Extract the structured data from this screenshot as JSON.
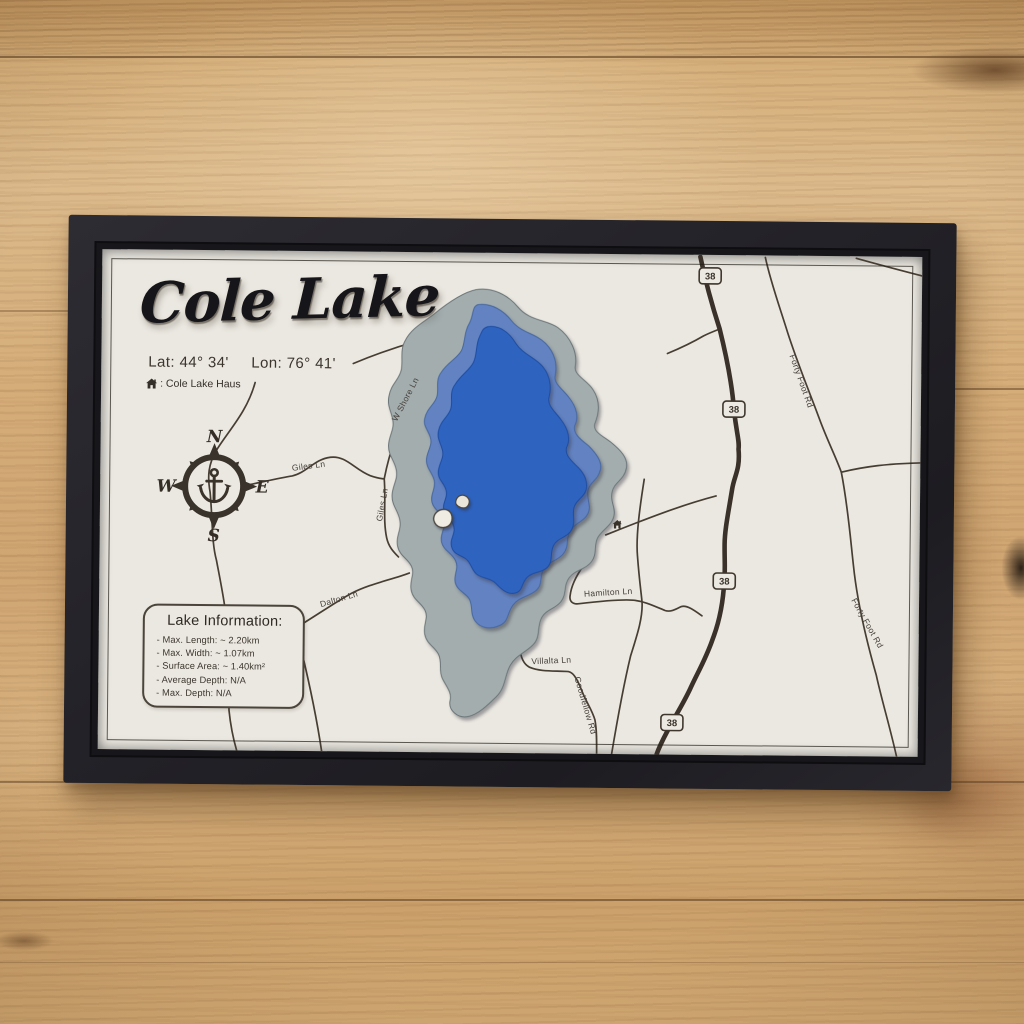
{
  "artwork": {
    "title": "Cole Lake",
    "lat_label": "Lat: 44° 34'",
    "lon_label": "Lon: 76° 41'",
    "legend_house_label": ": Cole Lake Haus",
    "compass": {
      "north": "N",
      "east": "E",
      "south": "S",
      "west": "W"
    },
    "lake_info": {
      "heading": "Lake Information:",
      "items": [
        "- Max. Length: ~ 2.20km",
        "- Max. Width: ~ 1.07km",
        "- Surface Area: ~ 1.40km²",
        "- Average Depth: N/A",
        "- Max. Depth: N/A"
      ]
    },
    "road_labels": {
      "giles_1": "Giles Ln",
      "w_shore": "W Shore Ln",
      "giles_2": "Giles Ln",
      "dalton": "Dalton Ln",
      "hamilton": "Hamilton Ln",
      "villalta": "Villalta Ln",
      "goodfellow": "Goodfellow Rd",
      "forty_foot_1": "Forty Foot Rd",
      "forty_foot_2": "Forty Foot Rd"
    },
    "route_shield": "38",
    "colors": {
      "frame": "#232227",
      "mat": "#ebe8e1",
      "contour_shallow": "#a3adae",
      "lake_mid": "#6282c1",
      "lake_deep": "#2f64c0",
      "road": "#473e33",
      "wood": "#d0a974"
    }
  }
}
